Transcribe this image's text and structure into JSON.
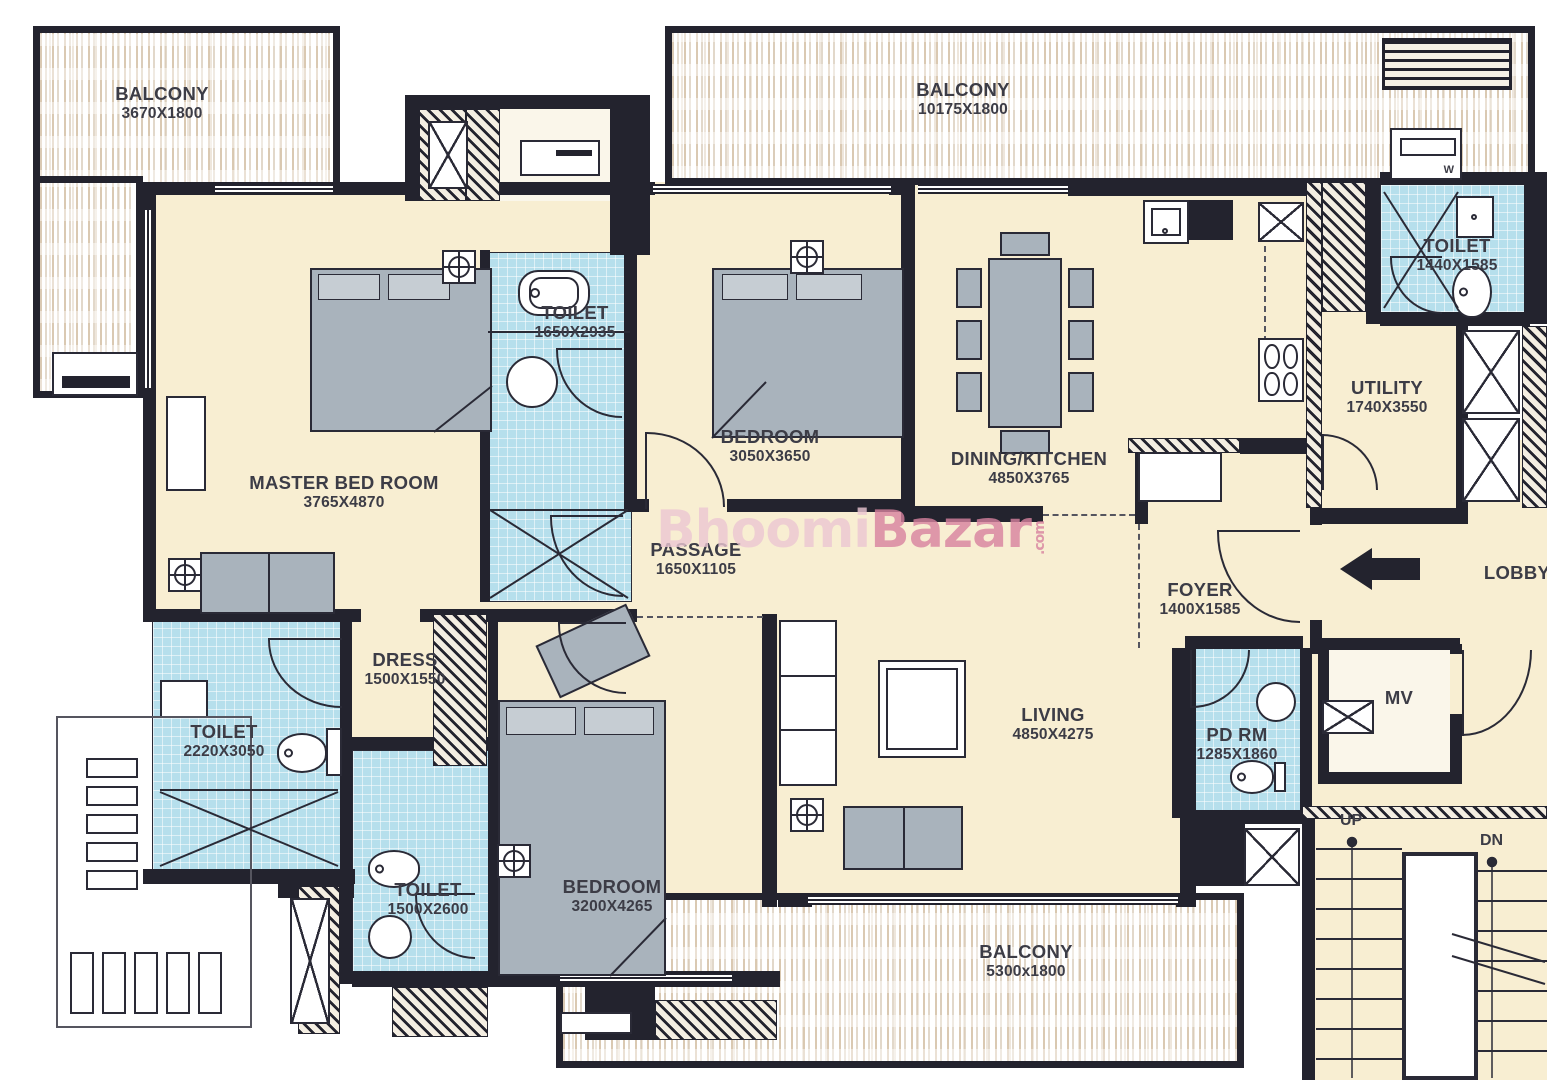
{
  "watermark": {
    "brand_light": "Bhoomi",
    "brand_dark": "Bazar",
    "tld": ".com"
  },
  "rooms": {
    "balcony_tl": {
      "name": "BALCONY",
      "dim": "3670X1800"
    },
    "balcony_top": {
      "name": "BALCONY",
      "dim": "10175X1800"
    },
    "master_bedroom": {
      "name": "MASTER BED ROOM",
      "dim": "3765X4870"
    },
    "toilet_master": {
      "name": "TOILET",
      "dim": "1650X2935"
    },
    "bedroom2": {
      "name": "BEDROOM",
      "dim": "3050X3650"
    },
    "dining_kitchen": {
      "name": "DINING/KITCHEN",
      "dim": "4850X3765"
    },
    "toilet_tr": {
      "name": "TOILET",
      "dim": "1440X1585"
    },
    "utility": {
      "name": "UTILITY",
      "dim": "1740X3550"
    },
    "passage": {
      "name": "PASSAGE",
      "dim": "1650X1105"
    },
    "foyer": {
      "name": "FOYER",
      "dim": "1400X1585"
    },
    "lobby": {
      "name": "LOBBY"
    },
    "dress": {
      "name": "DRESS",
      "dim": "1500X1550"
    },
    "toilet_left": {
      "name": "TOILET",
      "dim": "2220X3050"
    },
    "toilet_bl": {
      "name": "TOILET",
      "dim": "1500X2600"
    },
    "bedroom3": {
      "name": "BEDROOM",
      "dim": "3200X4265"
    },
    "living": {
      "name": "LIVING",
      "dim": "4850X4275"
    },
    "pd_rm": {
      "name": "PD RM",
      "dim": "1285X1860"
    },
    "mv": {
      "name": "MV"
    },
    "balcony_bottom": {
      "name": "BALCONY",
      "dim": "5300x1800"
    }
  },
  "stairs": {
    "up": "UP",
    "down": "DN"
  },
  "appliances": {
    "washing_machine": "W"
  },
  "colors": {
    "wall": "#23232e",
    "line": "#2a2a36",
    "cream": "#f8eed2",
    "wet": "#b6dfec",
    "gray": "#a9b3bc",
    "graylt": "#c6cdd3",
    "label": "#3c3c46",
    "hatchbg": "#f4eee2",
    "pink1": "#ecc7d3",
    "pink2": "#d8829f",
    "paper": "#ffffff",
    "stripe": "#d8c6ae"
  }
}
